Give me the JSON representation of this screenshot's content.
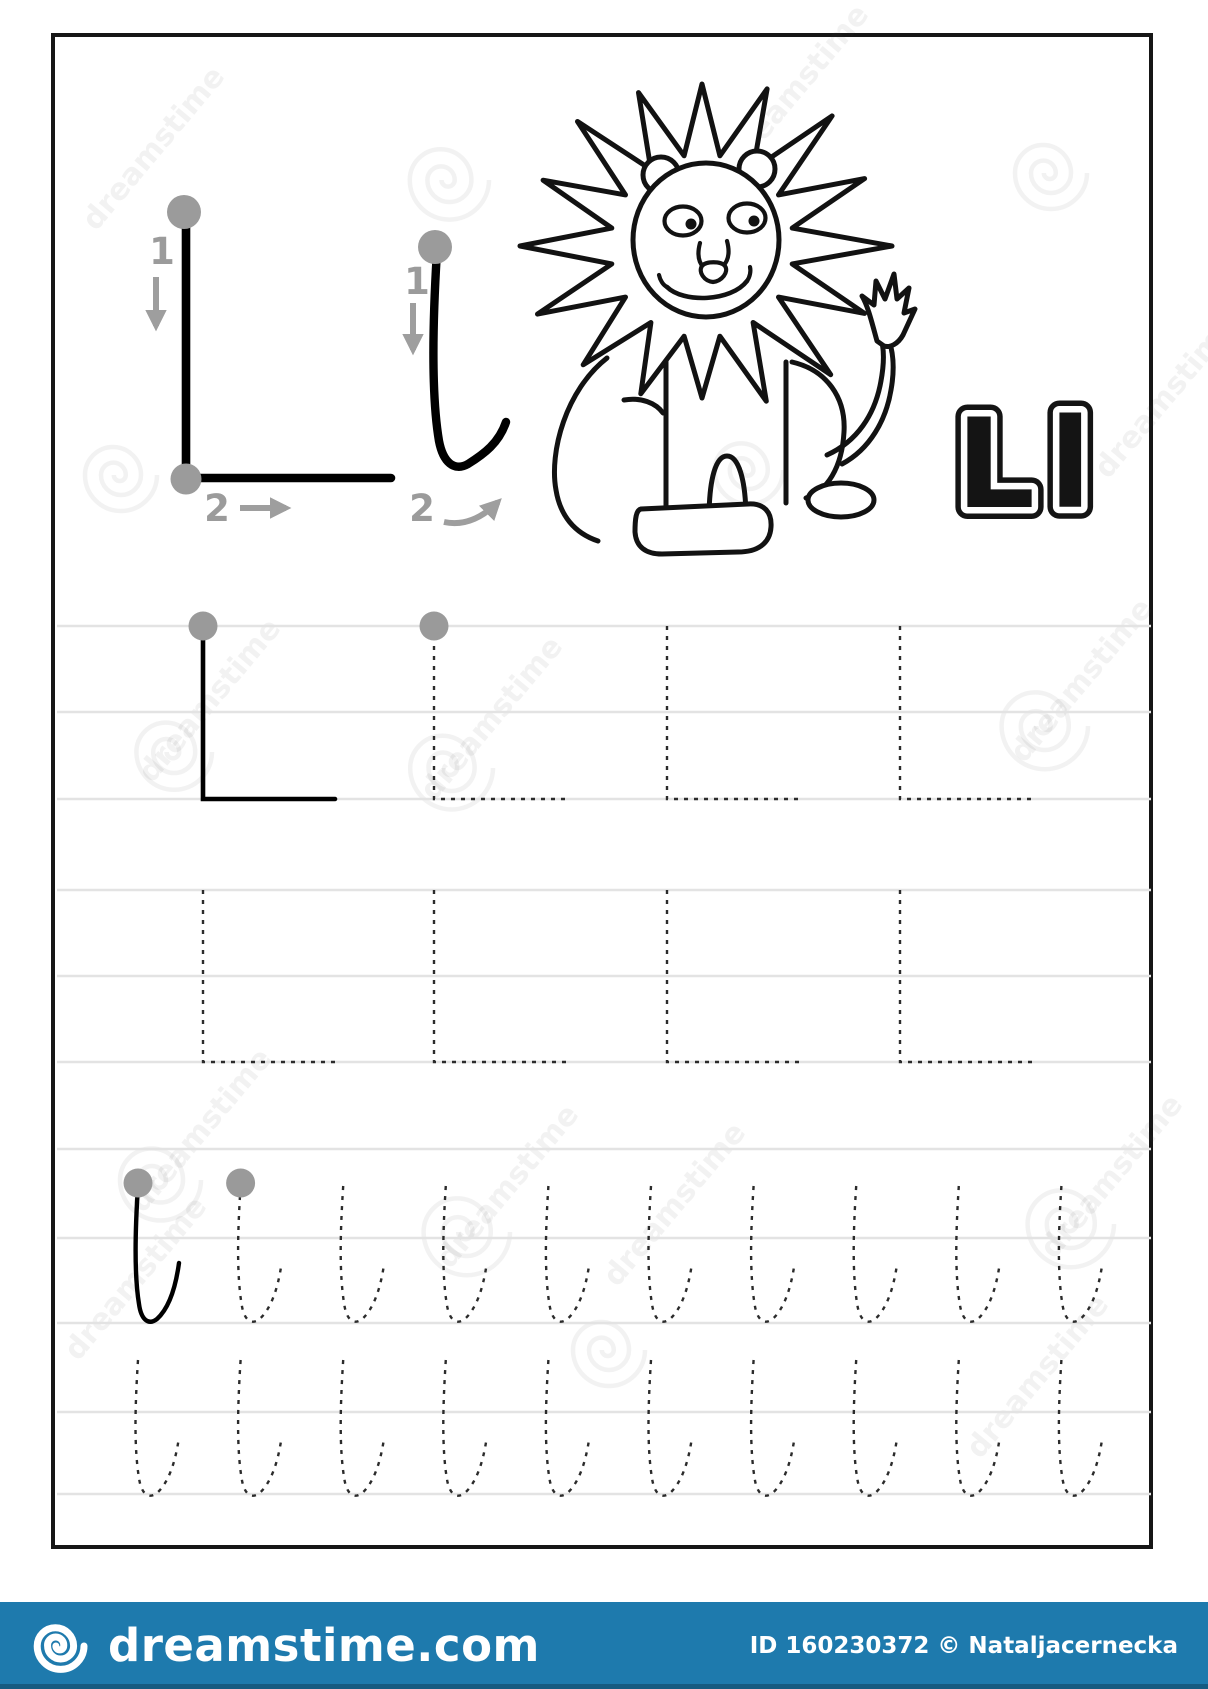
{
  "image_type": "alphabet-tracing-worksheet",
  "worksheet": {
    "display_pair": "Ll",
    "animal": "lion",
    "example_upper": {
      "stroke1_label": "1",
      "stroke2_label": "2"
    },
    "example_lower": {
      "stroke1_label": "1",
      "stroke2_label": "2"
    },
    "guidelines_y": [
      626,
      712,
      799,
      890,
      976,
      1062,
      1149,
      1238,
      1323,
      1412,
      1494
    ],
    "upper_rows": [
      {
        "y": 626,
        "height": 173,
        "arm": 132,
        "glyphs": [
          {
            "x": 203,
            "solid": true,
            "dot": true
          },
          {
            "x": 434,
            "solid": false,
            "dot": true
          },
          {
            "x": 667,
            "solid": false,
            "dot": false
          },
          {
            "x": 900,
            "solid": false,
            "dot": false
          }
        ]
      },
      {
        "y": 890,
        "height": 172,
        "arm": 132,
        "glyphs": [
          {
            "x": 203,
            "solid": false,
            "dot": false
          },
          {
            "x": 434,
            "solid": false,
            "dot": false
          },
          {
            "x": 667,
            "solid": false,
            "dot": false
          },
          {
            "x": 900,
            "solid": false,
            "dot": false
          }
        ]
      }
    ],
    "lower_rows": [
      {
        "y": 1186,
        "x_start": 138,
        "x_step": 102.6,
        "count": 10,
        "solid_idx": [
          0
        ],
        "dot_idx": [
          0,
          1
        ]
      },
      {
        "y": 1360,
        "x_start": 138,
        "x_step": 102.6,
        "count": 10,
        "solid_idx": [],
        "dot_idx": []
      }
    ]
  },
  "watermark": {
    "text": "dreamstime",
    "spirals": [
      [
        445,
        180,
        44
      ],
      [
        1047,
        173,
        40
      ],
      [
        117,
        475,
        40
      ],
      [
        745,
        470,
        38
      ],
      [
        170,
        752,
        42
      ],
      [
        447,
        768,
        46
      ],
      [
        1040,
        726,
        48
      ],
      [
        156,
        1180,
        45
      ],
      [
        462,
        1232,
        48
      ],
      [
        1066,
        1224,
        48
      ],
      [
        605,
        1350,
        40
      ]
    ],
    "texts": [
      [
        96,
        232
      ],
      [
        740,
        170
      ],
      [
        1108,
        480
      ],
      [
        152,
        784
      ],
      [
        434,
        802
      ],
      [
        1024,
        764
      ],
      [
        143,
        1214
      ],
      [
        450,
        1270
      ],
      [
        1054,
        1260
      ],
      [
        78,
        1362
      ],
      [
        617,
        1288
      ],
      [
        980,
        1460
      ]
    ]
  },
  "footer": {
    "brand": "dreamstime.com",
    "credit": "ID 160230372 © Nataljacernecka",
    "bar_color": "#1e7aad"
  },
  "colors": {
    "ink": "#000000",
    "dash": "#2b2b2b",
    "guideline": "#e3e3e3",
    "dot": "#9a9a9a",
    "arrow": "#9e9e9e"
  }
}
